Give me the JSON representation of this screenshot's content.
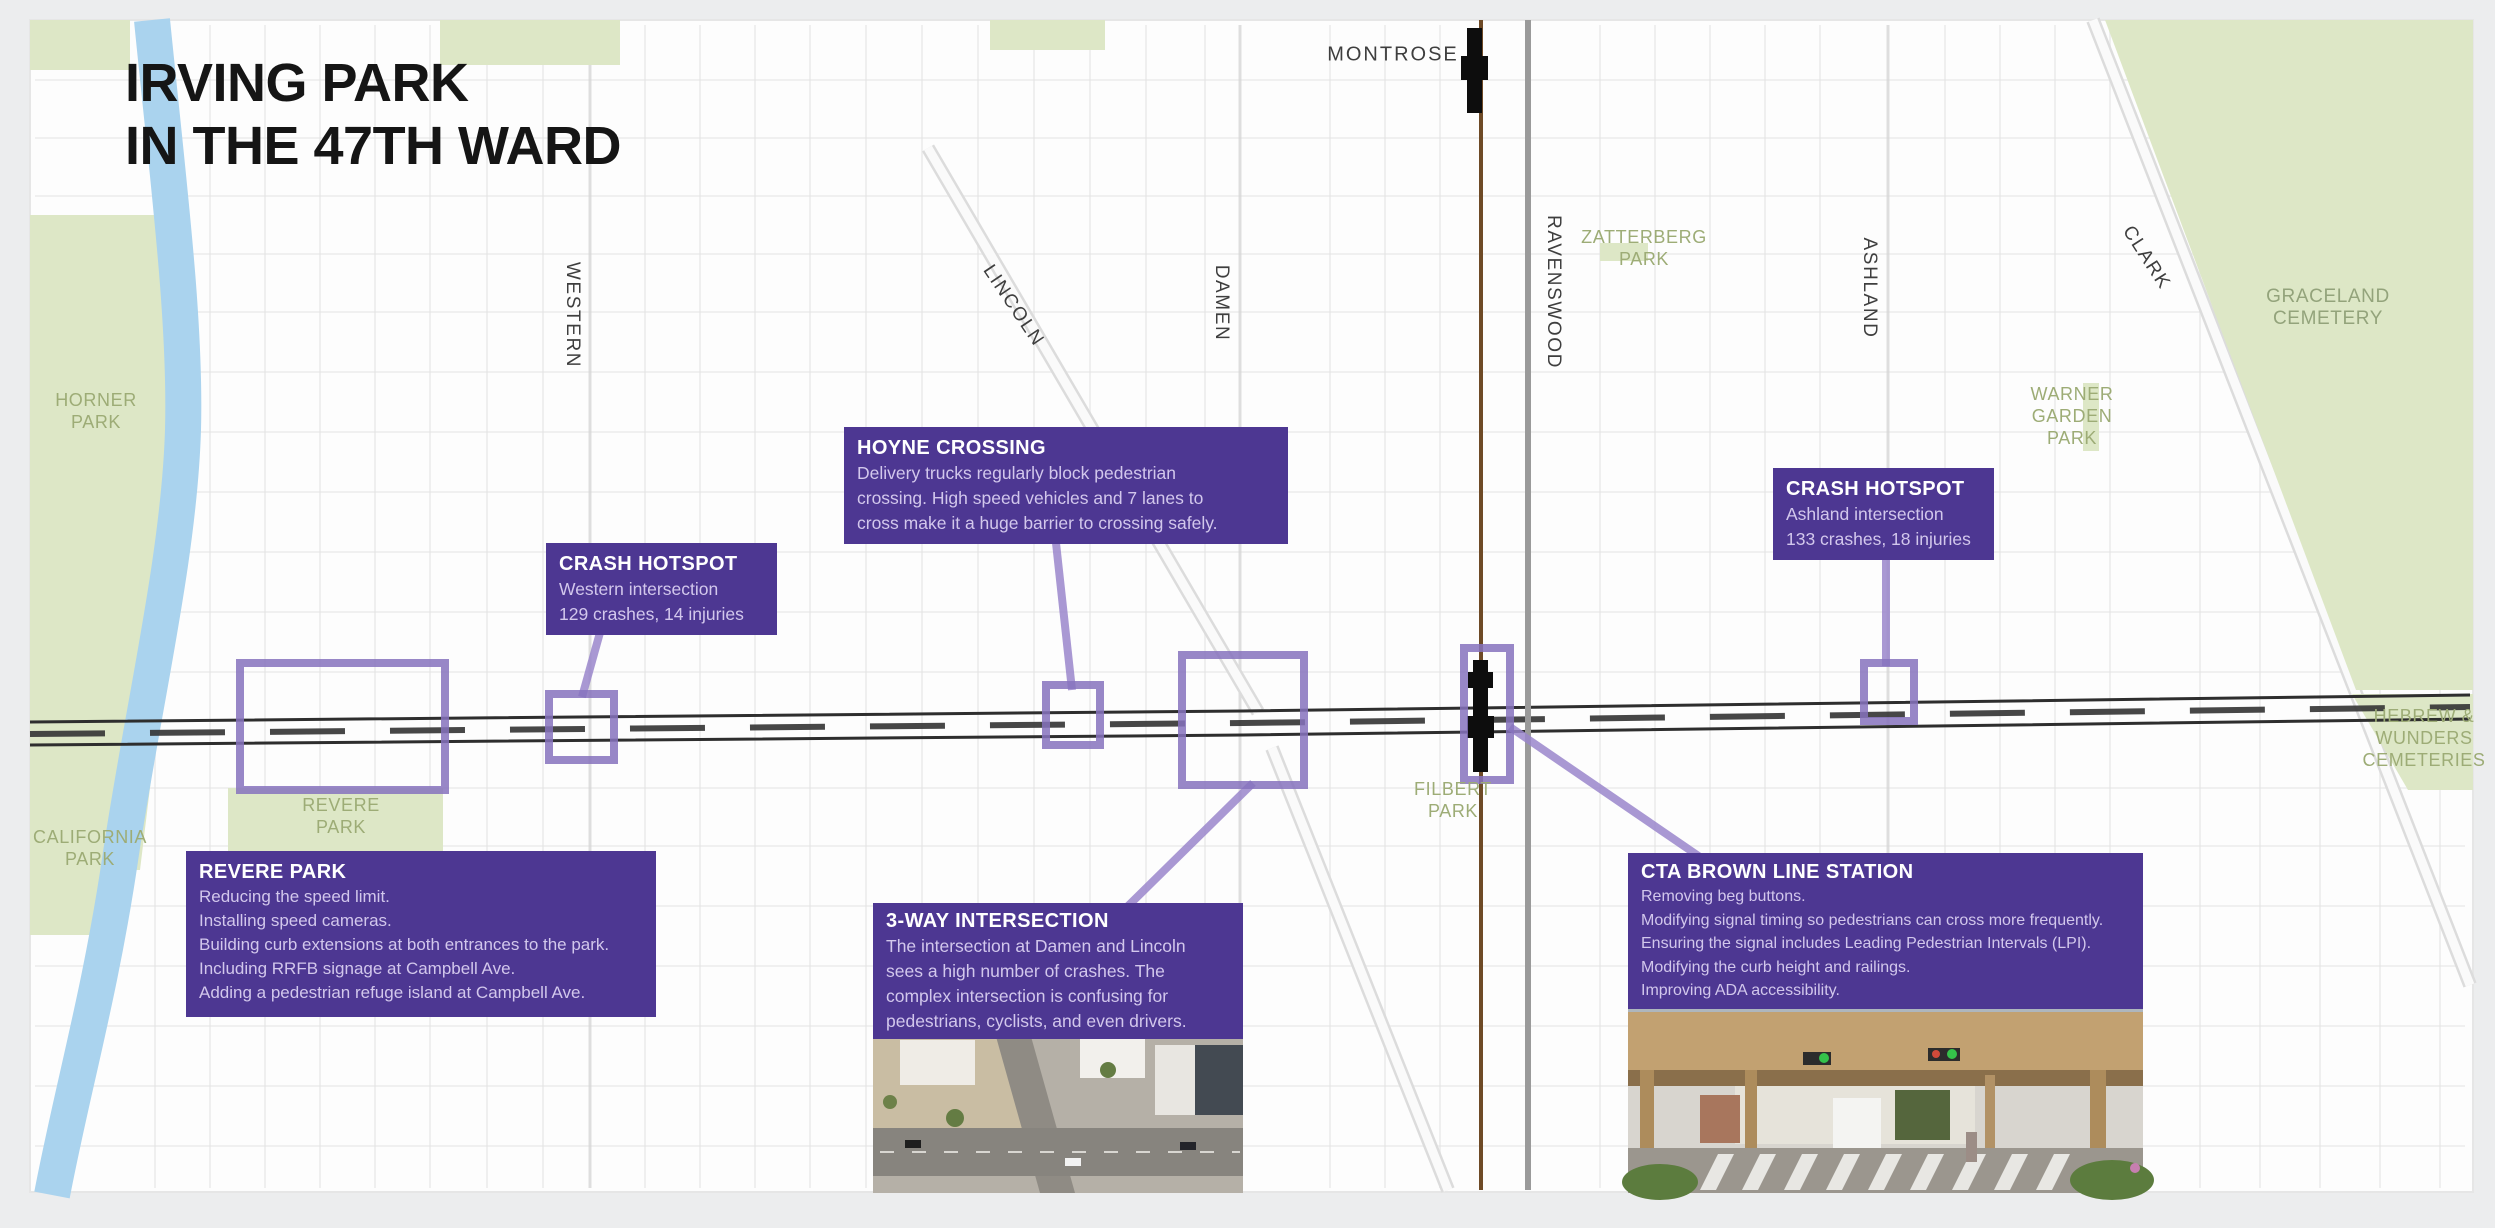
{
  "title": "IRVING PARK\nIN THE 47TH WARD",
  "colors": {
    "callout_purple": "#4d3792",
    "highlight_purple": "#8672bd",
    "park_green": "#dde7c6",
    "park_label_green": "#9dac76",
    "river_blue": "#aad3ee",
    "brown_line": "#6e4a26"
  },
  "streets": [
    {
      "id": "montrose",
      "label": "MONTROSE"
    },
    {
      "id": "western",
      "label": "WESTERN"
    },
    {
      "id": "lincoln",
      "label": "LINCOLN"
    },
    {
      "id": "damen",
      "label": "DAMEN"
    },
    {
      "id": "ravenswood",
      "label": "RAVENSWOOD"
    },
    {
      "id": "ashland",
      "label": "ASHLAND"
    },
    {
      "id": "clark",
      "label": "CLARK"
    }
  ],
  "places": [
    {
      "id": "horner-park",
      "label": "HORNER\nPARK"
    },
    {
      "id": "california-park",
      "label": "CALIFORNIA\nPARK"
    },
    {
      "id": "revere-park",
      "label": "REVERE\nPARK"
    },
    {
      "id": "zatterberg-park",
      "label": "ZATTERBERG\nPARK"
    },
    {
      "id": "warner-garden-park",
      "label": "WARNER\nGARDEN\nPARK"
    },
    {
      "id": "filbert-park",
      "label": "FILBERT\nPARK"
    },
    {
      "id": "graceland-cemetery",
      "label": "GRACELAND\nCEMETERY"
    },
    {
      "id": "hebrew-wunders-cemeteries",
      "label": "HEBREW &\nWUNDERS\nCEMETERIES"
    }
  ],
  "callouts": {
    "crash_western": {
      "title": "CRASH HOTSPOT",
      "lines": [
        "Western intersection",
        "129 crashes, 14 injuries"
      ]
    },
    "hoyne": {
      "title": "HOYNE CROSSING",
      "lines": [
        "Delivery trucks regularly block pedestrian",
        "crossing. High speed vehicles and 7 lanes to",
        "cross make it a huge barrier to crossing safely."
      ]
    },
    "crash_ashland": {
      "title": "CRASH HOTSPOT",
      "lines": [
        "Ashland intersection",
        "133 crashes, 18 injuries"
      ]
    },
    "revere": {
      "title": "REVERE PARK",
      "lines": [
        "Reducing the speed limit.",
        "Installing speed cameras.",
        "Building curb extensions at both entrances to the park.",
        "Including RRFB signage at Campbell Ave.",
        "Adding a pedestrian refuge island at Campbell Ave."
      ]
    },
    "three_way": {
      "title": "3-WAY INTERSECTION",
      "lines": [
        "The intersection at Damen and Lincoln",
        "sees a high number of crashes. The",
        "complex intersection is confusing for",
        "pedestrians, cyclists, and even drivers."
      ]
    },
    "cta": {
      "title": "CTA BROWN LINE STATION",
      "lines": [
        "Removing beg buttons.",
        "Modifying signal timing so pedestrians can cross more frequently.",
        "Ensuring the signal includes Leading Pedestrian Intervals (LPI).",
        "Modifying the curb height and railings.",
        "Improving ADA accessibility."
      ]
    }
  }
}
